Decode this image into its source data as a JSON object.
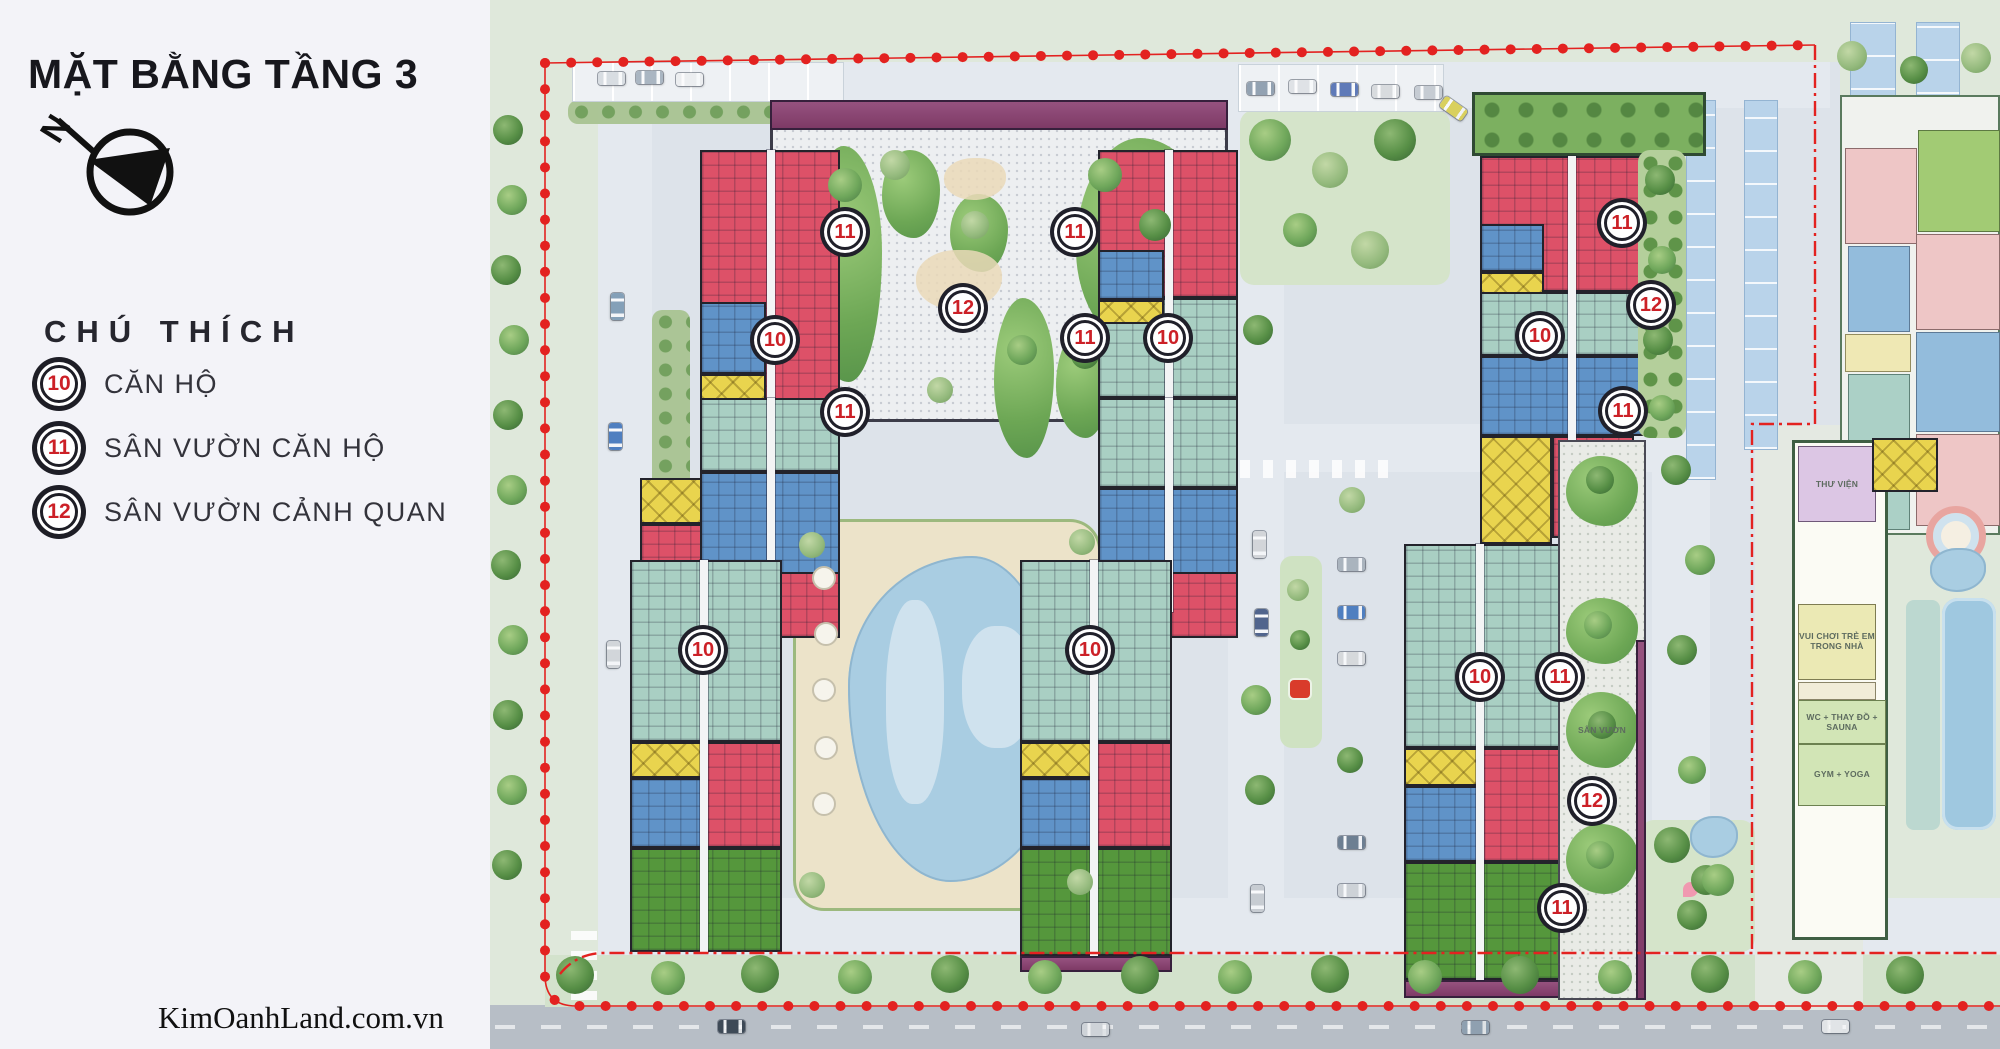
{
  "panel": {
    "title": "MẶT BẰNG TẦNG 3",
    "north_label": "N",
    "legend_heading": "CHÚ THÍCH",
    "legend": [
      {
        "num": "10",
        "label": "CĂN HỘ"
      },
      {
        "num": "11",
        "label": "SÂN VƯỜN CĂN HỘ"
      },
      {
        "num": "12",
        "label": "SÂN VƯỜN CẢNH QUAN"
      }
    ],
    "watermark": "KimOanhLand.com.vn"
  },
  "map": {
    "badges": [
      {
        "n": "11",
        "x": 845,
        "y": 232
      },
      {
        "n": "11",
        "x": 1075,
        "y": 232
      },
      {
        "n": "12",
        "x": 963,
        "y": 308
      },
      {
        "n": "10",
        "x": 775,
        "y": 340
      },
      {
        "n": "11",
        "x": 1085,
        "y": 338
      },
      {
        "n": "10",
        "x": 1168,
        "y": 338
      },
      {
        "n": "11",
        "x": 845,
        "y": 412
      },
      {
        "n": "10",
        "x": 703,
        "y": 650
      },
      {
        "n": "10",
        "x": 1090,
        "y": 650
      },
      {
        "n": "11",
        "x": 1622,
        "y": 223
      },
      {
        "n": "12",
        "x": 1651,
        "y": 305
      },
      {
        "n": "10",
        "x": 1540,
        "y": 336
      },
      {
        "n": "11",
        "x": 1623,
        "y": 411
      },
      {
        "n": "10",
        "x": 1480,
        "y": 677
      },
      {
        "n": "11",
        "x": 1560,
        "y": 677
      },
      {
        "n": "12",
        "x": 1592,
        "y": 801
      },
      {
        "n": "11",
        "x": 1562,
        "y": 908
      }
    ],
    "room_labels": [
      {
        "text": "THƯ VIỆN",
        "x": 1837,
        "y": 484
      },
      {
        "text": "VUI CHƠI TRẺ EM TRONG NHÀ",
        "x": 1837,
        "y": 641
      },
      {
        "text": "WC + THAY ĐỒ + SAUNA",
        "x": 1842,
        "y": 722
      },
      {
        "text": "GYM + YOGA",
        "x": 1842,
        "y": 774
      },
      {
        "text": "SÂN VƯỜN",
        "x": 1602,
        "y": 730
      }
    ],
    "colors": {
      "red": "#dd5168",
      "blue": "#6093c8",
      "teal": "#a9cfc3",
      "green": "#55973c",
      "yellow": "#e9d44e",
      "purple": "#96527f",
      "pool": "#a9cde2",
      "boundary": "#e42320"
    }
  }
}
